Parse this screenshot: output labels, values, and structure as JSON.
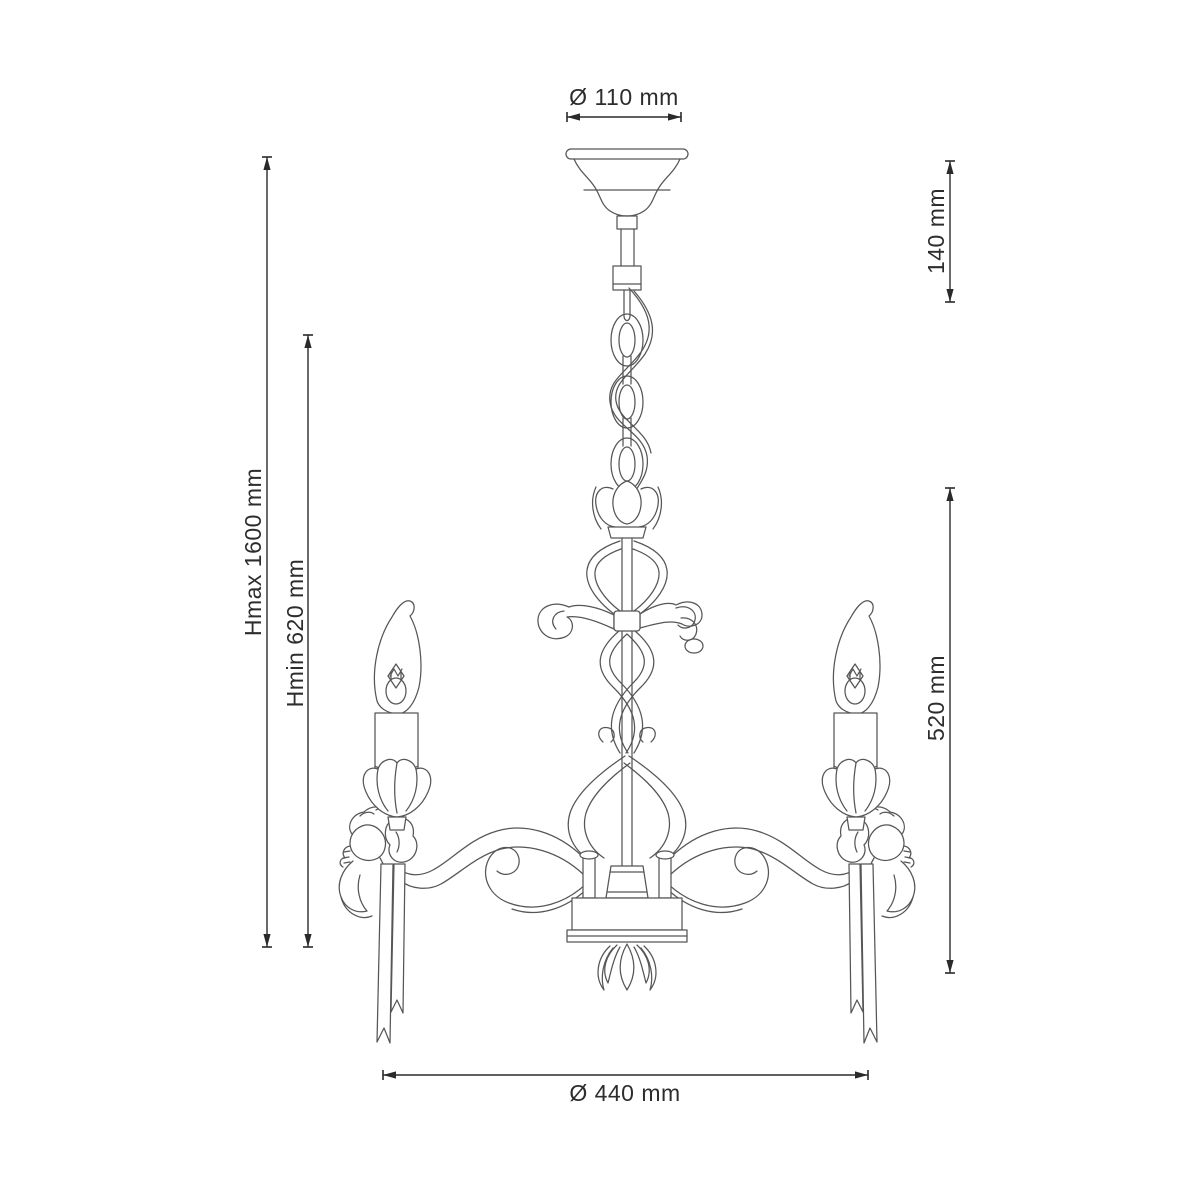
{
  "diagram": {
    "type": "technical-dimension-drawing",
    "subject": "chandelier-3-arm-with-cherubs",
    "background_color": "#ffffff",
    "artwork_line_color": "#565656",
    "dimension_line_color": "#2a2a2a",
    "dimension_text_color": "#2d2d2d",
    "dimensions": {
      "canopy_diameter": "Ø 110 mm",
      "canopy_drop": "140 mm",
      "height_max": "Hmax 1600 mm",
      "height_min": "Hmin 620 mm",
      "fixture_height": "520 mm",
      "fixture_diameter": "Ø 440 mm"
    }
  }
}
